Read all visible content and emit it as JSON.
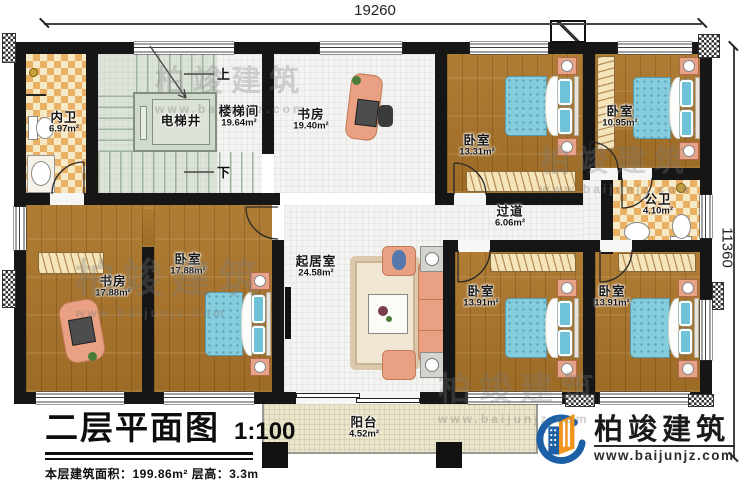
{
  "dimensions": {
    "top": "19260",
    "right": "11360"
  },
  "rooms": [
    {
      "name": "内卫",
      "area": "6.97m²"
    },
    {
      "name": "电梯井",
      "area": ""
    },
    {
      "name": "楼梯间",
      "area": "19.64m²"
    },
    {
      "name": "书房",
      "area": "19.40m²"
    },
    {
      "name": "卧室",
      "area": "13.31m²"
    },
    {
      "name": "卧室",
      "area": "10.95m²"
    },
    {
      "name": "公卫",
      "area": "4.10m²"
    },
    {
      "name": "过道",
      "area": "6.06m²"
    },
    {
      "name": "起居室",
      "area": "24.58m²"
    },
    {
      "name": "书房",
      "area": "17.88m²"
    },
    {
      "name": "卧室",
      "area": "17.88m²"
    },
    {
      "name": "卧室",
      "area": "13.91m²"
    },
    {
      "name": "卧室",
      "area": "13.91m²"
    },
    {
      "name": "阳台",
      "area": "4.52m²"
    }
  ],
  "stairs": {
    "up": "上",
    "down": "下"
  },
  "title": {
    "name": "二层平面图",
    "scale": "1:100",
    "area_line": "本层建筑面积：199.86m²  层高：3.3m",
    "note_line": "注：阳台算半面积，露台不算面积"
  },
  "brand": {
    "name": "柏竣建筑",
    "url": "www.baijunjz.com"
  },
  "watermark": {
    "name": "柏竣建筑",
    "url": "www.baijunjz.com"
  },
  "colors": {
    "wall": "#161616",
    "wood": "#a5732c",
    "tile": "#f3f3f1",
    "stair": "#dce4da",
    "checker_light": "#f6e9c6",
    "checker_dark": "#eab063",
    "balcony": "#ebe6c9",
    "bed": "#82cbdc",
    "furniture": "#eba98b",
    "brand_blue": "#1b5fa6",
    "brand_orange": "#f0941d"
  }
}
